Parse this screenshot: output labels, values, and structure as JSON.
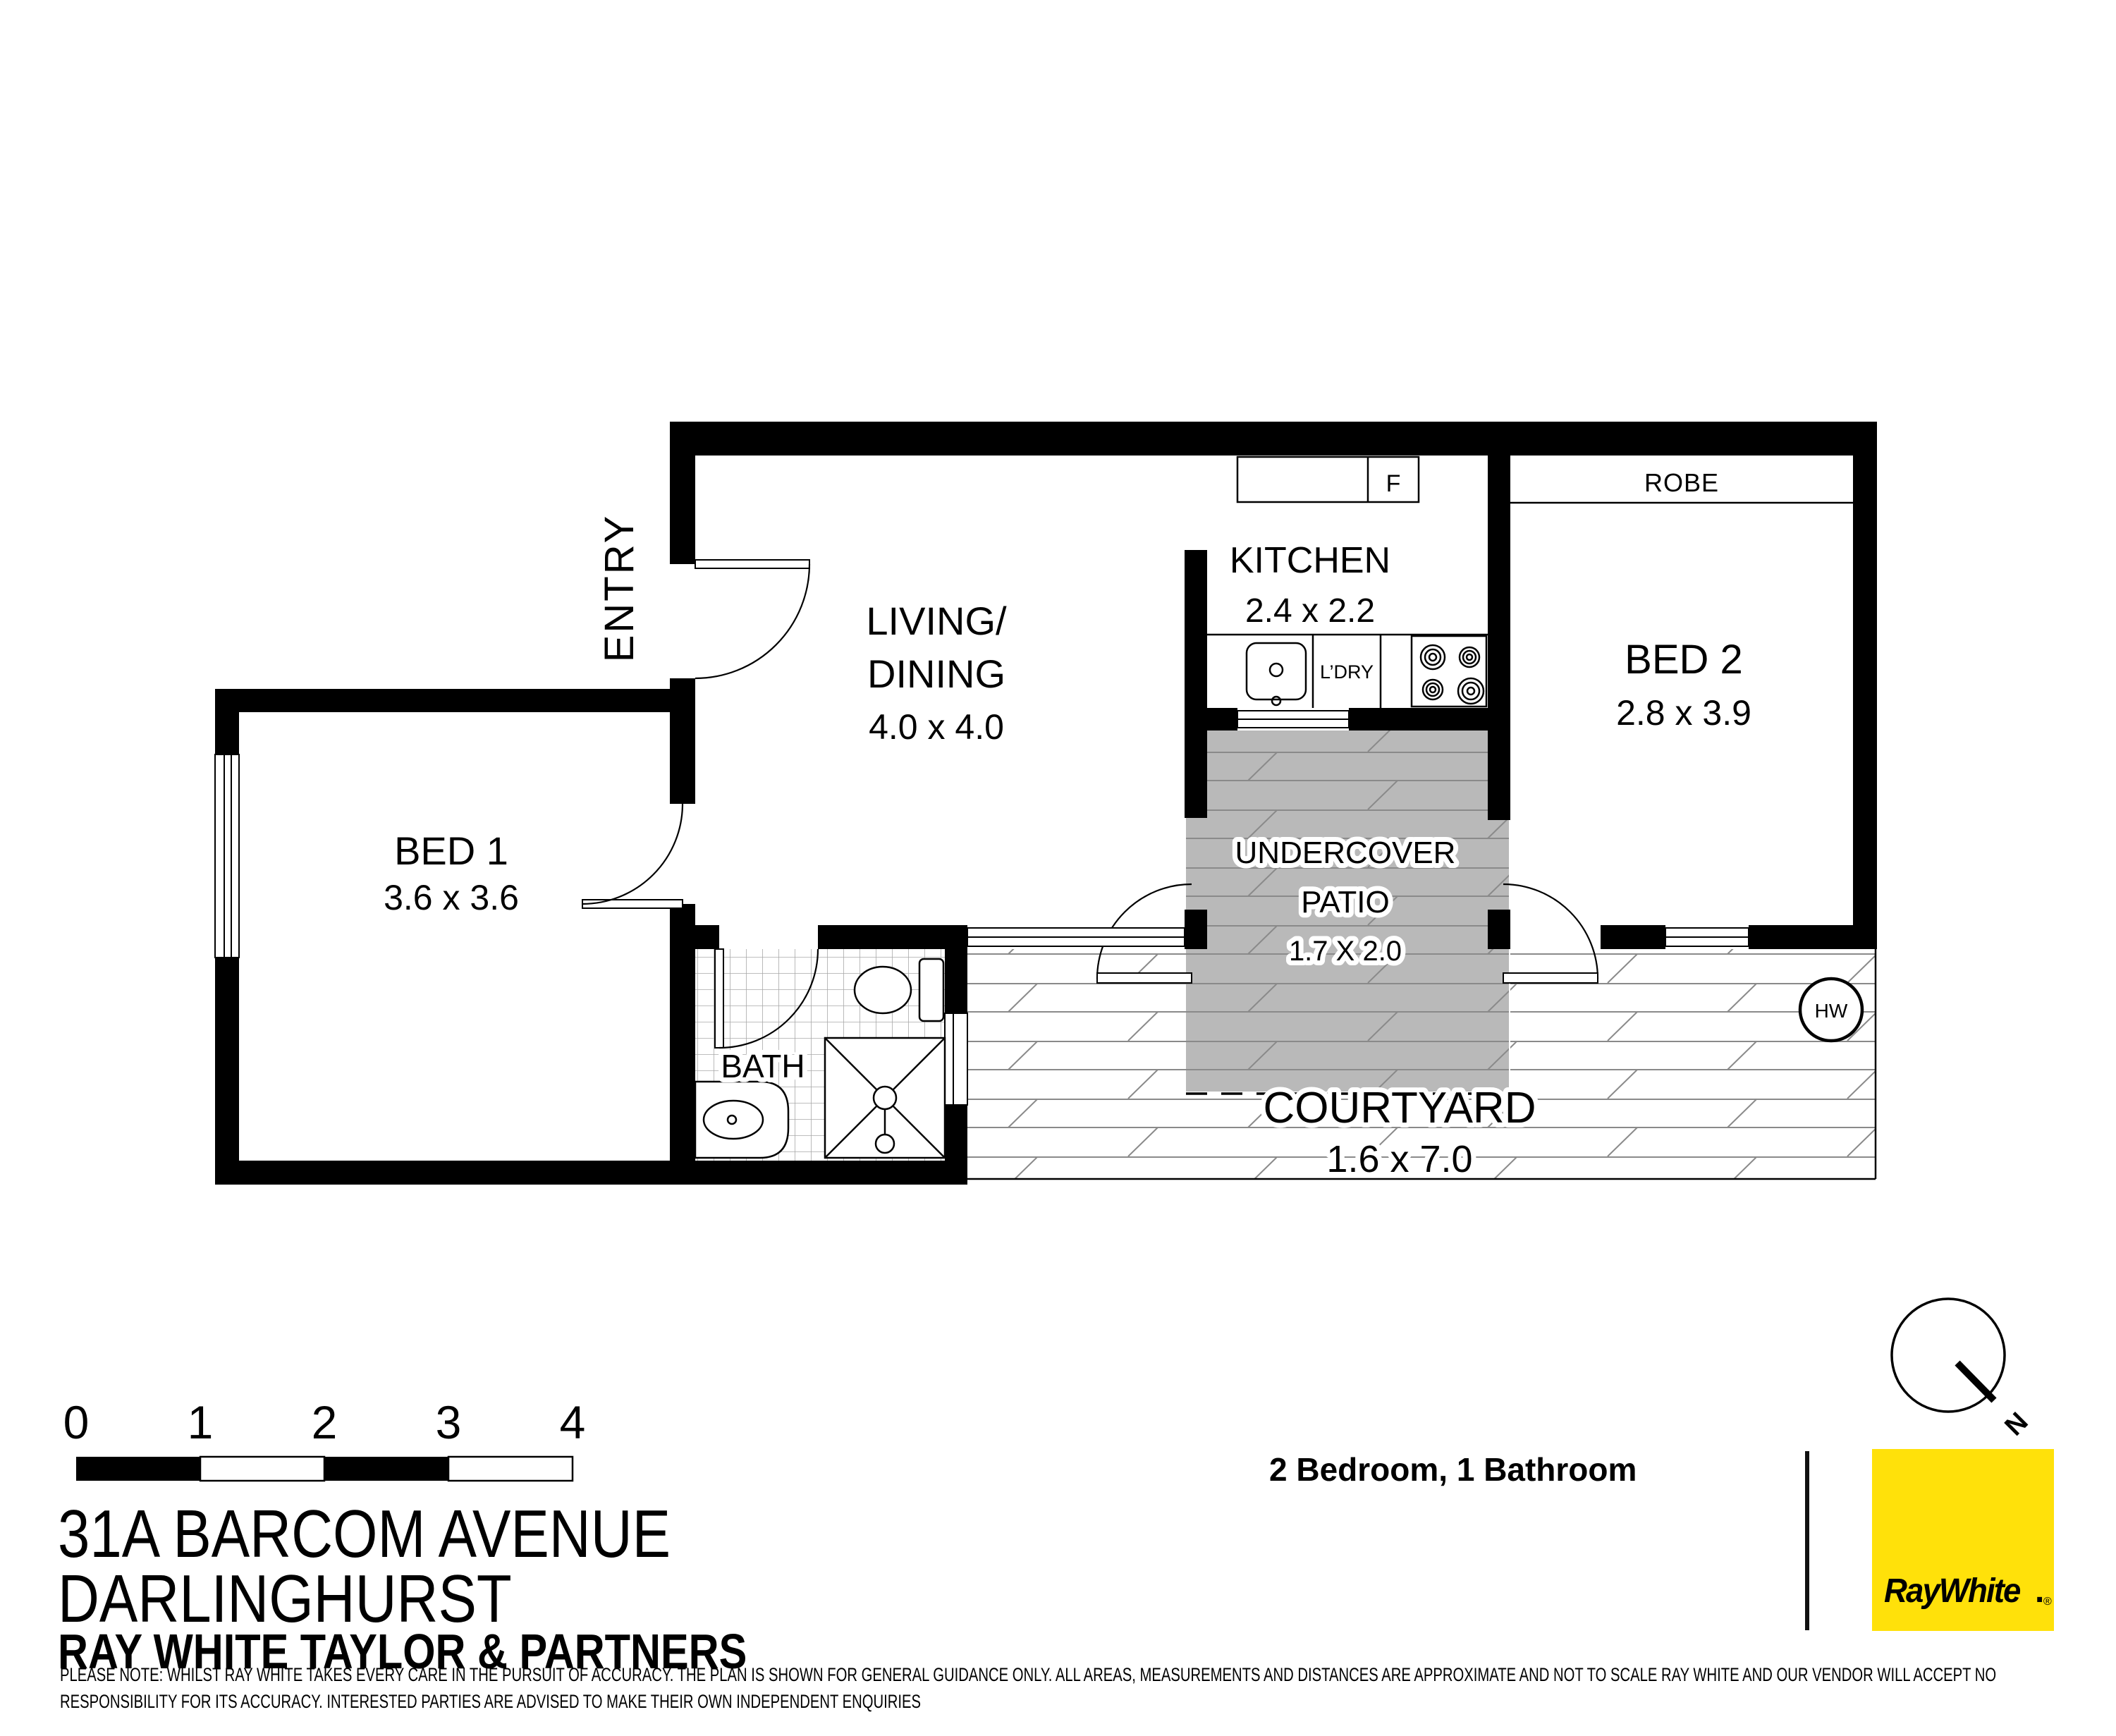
{
  "plan": {
    "entry_label": "ENTRY",
    "living": {
      "name_line1": "LIVING/",
      "name_line2": "DINING",
      "dims": "4.0 x 4.0"
    },
    "kitchen": {
      "name": "KITCHEN",
      "dims": "2.4 x 2.2",
      "fridge": "F",
      "laundry": "L’DRY"
    },
    "bed2": {
      "name": "BED 2",
      "dims": "2.8 x 3.9",
      "robe": "ROBE"
    },
    "patio": {
      "name_line1": "UNDERCOVER",
      "name_line2": "PATIO",
      "dims": "1.7 X 2.0"
    },
    "bed1": {
      "name": "BED 1",
      "dims": "3.6 x 3.6"
    },
    "bath": {
      "name": "BATH"
    },
    "courtyard": {
      "name": "COURTYARD",
      "dims": "1.6 x 7.0",
      "hot_water": "HW"
    },
    "compass_north": "N"
  },
  "scale_bar": {
    "ticks": [
      "0",
      "1",
      "2",
      "3",
      "4"
    ]
  },
  "footer": {
    "address_line1": "31A BARCOM AVENUE",
    "address_line2": "DARLINGHURST",
    "agency": "RAY WHITE TAYLOR & PARTNERS",
    "features": "2 Bedroom, 1 Bathroom",
    "logo_text": "RayWhite",
    "logo_period": ".",
    "logo_registered": "®",
    "disclaimer_line1": "PLEASE NOTE: WHILST RAY WHITE TAKES EVERY CARE IN THE PURSUIT OF ACCURACY. THE PLAN IS SHOWN FOR GENERAL GUIDANCE ONLY. ALL AREAS, MEASUREMENTS AND DISTANCES ARE APPROXIMATE AND NOT TO SCALE RAY WHITE AND OUR VENDOR WILL ACCEPT NO",
    "disclaimer_line2": "RESPONSIBILITY FOR ITS ACCURACY. INTERESTED PARTIES ARE ADVISED TO MAKE THEIR OWN INDEPENDENT ENQUIRIES"
  },
  "colors": {
    "brand_yellow": "#FFE10A",
    "logo_text_gray": "#54565A",
    "patio_gray": "#B9B9B9",
    "feature_text": "#2D2D2D"
  }
}
